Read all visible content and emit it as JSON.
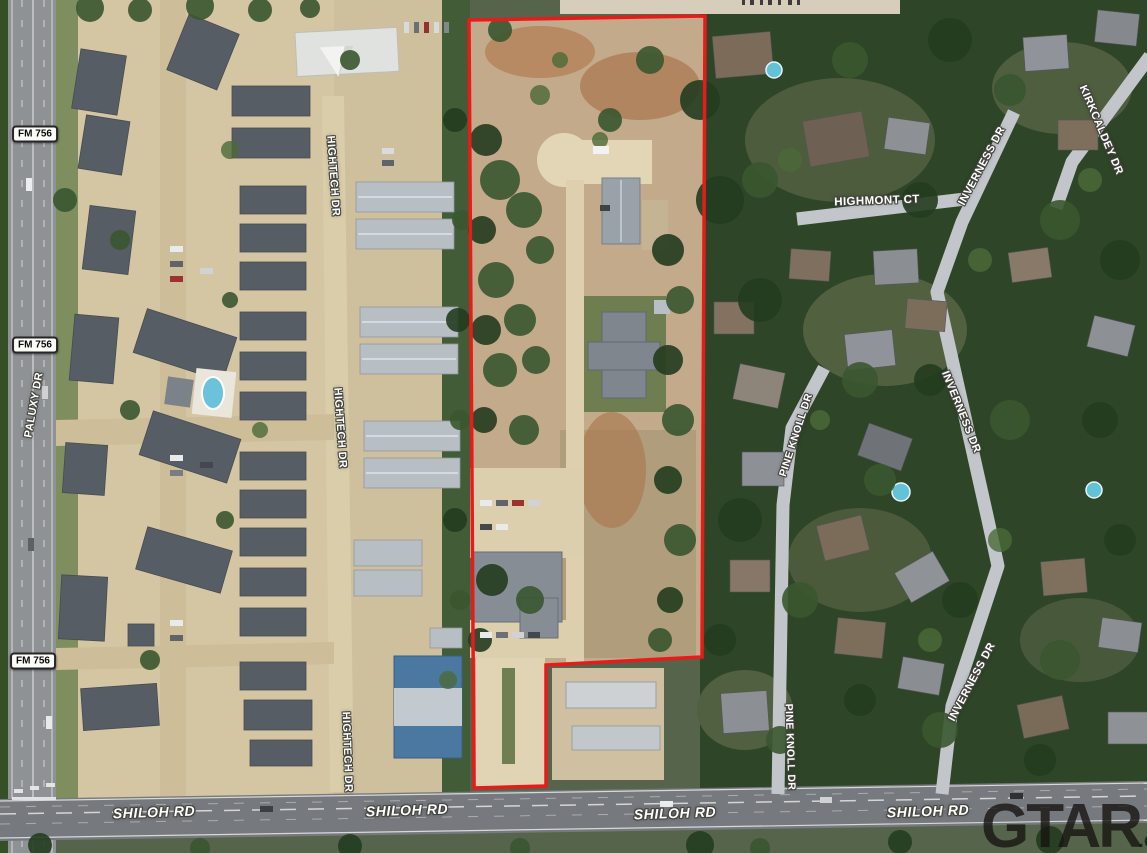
{
  "map": {
    "type": "aerial-satellite-parcel-map",
    "watermark": {
      "brand": "GTAR",
      "suffix": ".com"
    },
    "parcel_outline": {
      "color": "#e81b1b",
      "stroke_width": 3.5,
      "points": "469,20 705,16 702,657 546,665 546,786 474,788"
    },
    "route_badges": [
      {
        "id": "fm-756-badge-north",
        "text": "FM 756",
        "x": 35,
        "y": 134
      },
      {
        "id": "fm-756-badge-mid",
        "text": "FM 756",
        "x": 35,
        "y": 345
      },
      {
        "id": "fm-756-badge-south",
        "text": "FM 756",
        "x": 33,
        "y": 661
      }
    ],
    "road_labels": [
      {
        "id": "paluxy-dr",
        "text": "PALUXY DR",
        "x": 34,
        "y": 405,
        "rotate": -80,
        "size": 11
      },
      {
        "id": "hightech-dr-north",
        "text": "HIGHTECH DR",
        "x": 333,
        "y": 176,
        "rotate": 86,
        "size": 11
      },
      {
        "id": "hightech-dr-mid",
        "text": "HIGHTECH DR",
        "x": 340,
        "y": 428,
        "rotate": 86,
        "size": 11
      },
      {
        "id": "hightech-dr-south",
        "text": "HIGHTECH DR",
        "x": 347,
        "y": 752,
        "rotate": 88,
        "size": 11
      },
      {
        "id": "shiloh-rd-1",
        "text": "SHILOH RD",
        "x": 154,
        "y": 812,
        "rotate": -2,
        "size": 14,
        "italic": true
      },
      {
        "id": "shiloh-rd-2",
        "text": "SHILOH RD",
        "x": 407,
        "y": 810,
        "rotate": -2,
        "size": 14,
        "italic": true
      },
      {
        "id": "shiloh-rd-3",
        "text": "SHILOH RD",
        "x": 675,
        "y": 813,
        "rotate": -2,
        "size": 14,
        "italic": true
      },
      {
        "id": "shiloh-rd-4",
        "text": "SHILOH RD",
        "x": 928,
        "y": 811,
        "rotate": -2,
        "size": 14,
        "italic": true
      },
      {
        "id": "highmont-ct",
        "text": "HIGHMONT CT",
        "x": 877,
        "y": 201,
        "rotate": -2,
        "size": 11.5
      },
      {
        "id": "inverness-dr-north",
        "text": "INVERNESS DR",
        "x": 982,
        "y": 166,
        "rotate": -62,
        "size": 11
      },
      {
        "id": "inverness-dr-mid",
        "text": "INVERNESS DR",
        "x": 961,
        "y": 412,
        "rotate": 68,
        "size": 11
      },
      {
        "id": "inverness-dr-south",
        "text": "INVERNESS DR",
        "x": 972,
        "y": 682,
        "rotate": -62,
        "size": 11
      },
      {
        "id": "kirkcaldey-dr",
        "text": "KIRKCALDEY DR",
        "x": 1101,
        "y": 130,
        "rotate": 67,
        "size": 11
      },
      {
        "id": "pine-knoll-dr-north",
        "text": "PINE KNOLL DR",
        "x": 796,
        "y": 435,
        "rotate": -72,
        "size": 10.5
      },
      {
        "id": "pine-knoll-dr-south",
        "text": "PINE KNOLL DR",
        "x": 790,
        "y": 747,
        "rotate": 88,
        "size": 10.5
      }
    ]
  }
}
